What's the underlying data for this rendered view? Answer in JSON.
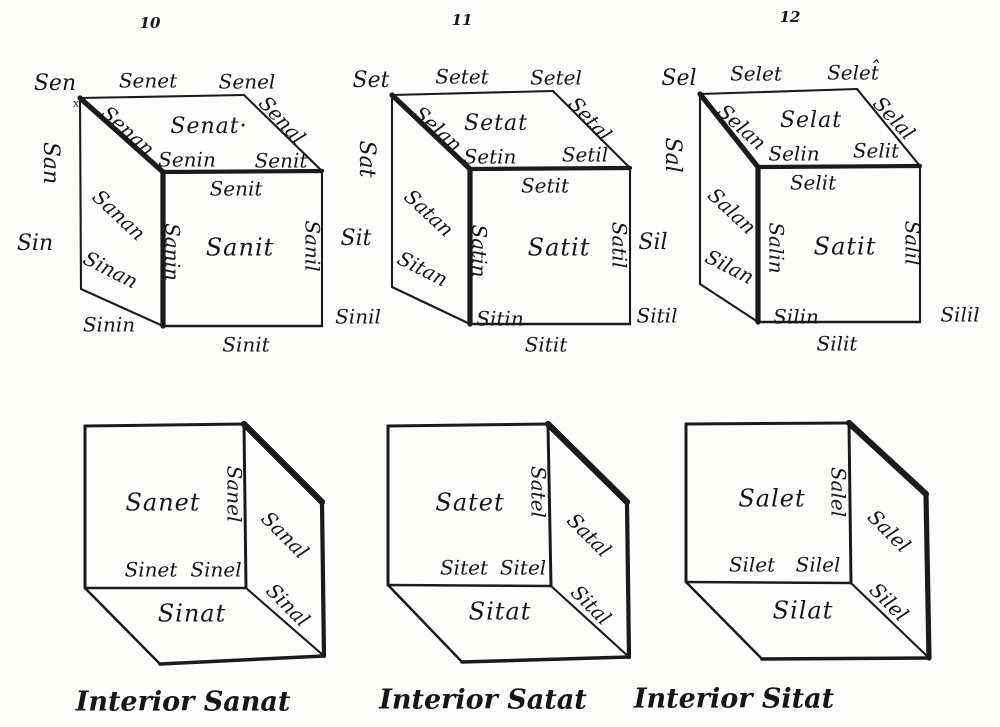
{
  "ink_color": "#1b1b1b",
  "paper_color": "#fdfdfb",
  "figure_numbers": [
    "10",
    "11",
    "12"
  ],
  "corner_mark": "x",
  "exterior": [
    {
      "number": "10",
      "corner_back_top_left": "Sen",
      "edge_back_top": "Senet",
      "corner_back_top_right": "Senel",
      "edge_left_back": "San",
      "edge_top_left": "Senan",
      "face_top": "Senat·",
      "edge_top_right": "Senal",
      "corner_front_top_left": "Senin",
      "corner_front_top_right": "Senit",
      "edge_front_top": "Senit",
      "face_left": "Sanan",
      "corner_back_bottom_left": "Sin",
      "edge_bottom_left": "Sinan",
      "edge_front_left": "Sanin",
      "face_front": "Sanit",
      "edge_front_right": "Sanil",
      "corner_front_bottom_left": "Sinin",
      "edge_front_bottom": "Sinit",
      "corner_front_bottom_right": "Sinil"
    },
    {
      "number": "11",
      "corner_back_top_left": "Set",
      "edge_back_top": "Setet",
      "corner_back_top_right": "Setel",
      "edge_left_back": "Sat",
      "edge_top_left": "Selan",
      "face_top": "Setat",
      "edge_top_right": "Setal",
      "corner_front_top_left": "Setin",
      "corner_front_top_right": "Setil",
      "edge_front_top": "Setit",
      "face_left": "Satan",
      "corner_back_bottom_left": "Sit",
      "edge_bottom_left": "Sitan",
      "edge_front_left": "Satin",
      "face_front": "Satit",
      "edge_front_right": "Satil",
      "corner_front_bottom_left": "Sitin",
      "edge_front_bottom": "Sitit",
      "corner_front_bottom_right": "Sitil"
    },
    {
      "number": "12",
      "corner_back_top_left": "Sel",
      "edge_back_top": "Selet",
      "corner_back_top_right": "Selet̂",
      "edge_left_back": "Sal",
      "edge_top_left": "Selan",
      "face_top": "Selat",
      "edge_top_right": "Selal",
      "corner_front_top_left": "Selin",
      "corner_front_top_right": "Selit",
      "edge_front_top": "Selit",
      "face_left": "Salan",
      "corner_back_bottom_left": "Sil",
      "edge_bottom_left": "Silan",
      "edge_front_left": "Salin",
      "face_front": "Satit",
      "edge_front_right": "Salil",
      "corner_front_bottom_left": "Silin",
      "edge_front_bottom": "Silit",
      "corner_front_bottom_right": "Silil"
    }
  ],
  "interior": [
    {
      "face_front": "Sanet",
      "edge_front_right": "Sanel",
      "face_right": "Sanal",
      "edge_front_bottom_left": "Sinet",
      "edge_front_bottom_right": "Sinel",
      "edge_right_bottom": "Sinal",
      "face_bottom": "Sinat",
      "caption": "Interior Sanat"
    },
    {
      "face_front": "Satet",
      "edge_front_right": "Satel",
      "face_right": "Satal",
      "edge_front_bottom_left": "Sitet",
      "edge_front_bottom_right": "Sitel",
      "edge_right_bottom": "Sital",
      "face_bottom": "Sitat",
      "caption": "Interior Satat"
    },
    {
      "face_front": "Salet",
      "edge_front_right": "Salel",
      "face_right": "Salel",
      "edge_front_bottom_left": "Silet",
      "edge_front_bottom_right": "Silel",
      "edge_right_bottom": "Silel",
      "face_bottom": "Silat",
      "caption": "Interior Sitat"
    }
  ]
}
